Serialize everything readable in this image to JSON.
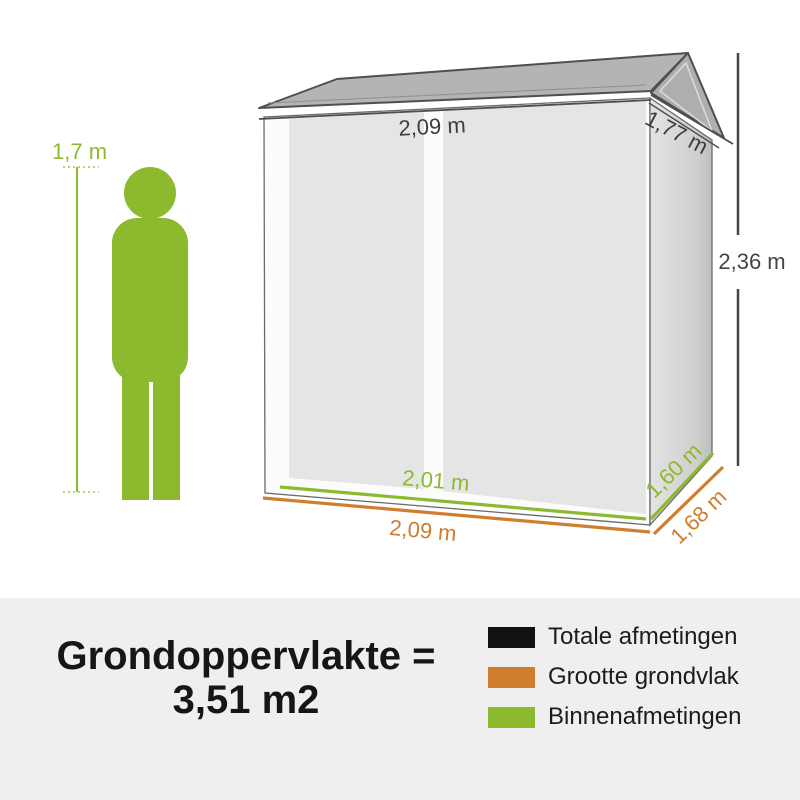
{
  "person": {
    "height_label": "1,7 m"
  },
  "dimensions": {
    "roof_width": "2,09 m",
    "roof_depth": "1,77 m",
    "total_height": "2,36 m",
    "inner_width": "2,01 m",
    "inner_depth": "1,60 m",
    "base_width": "2,09 m",
    "base_depth": "1,68 m"
  },
  "summary": {
    "line1": "Grondoppervlakte =",
    "line2": "3,51 m2"
  },
  "legend": {
    "items": [
      {
        "label": "Totale afmetingen",
        "color": "#121212"
      },
      {
        "label": "Grootte grondvlak",
        "color": "#d07d2e"
      },
      {
        "label": "Binnenafmetingen",
        "color": "#8db92f"
      }
    ]
  },
  "colors": {
    "green": "#8db92f",
    "orange": "#d07d2e",
    "dark_line": "#454545",
    "label_dark": "#3d3d3d",
    "panel_bg": "#efefef"
  }
}
